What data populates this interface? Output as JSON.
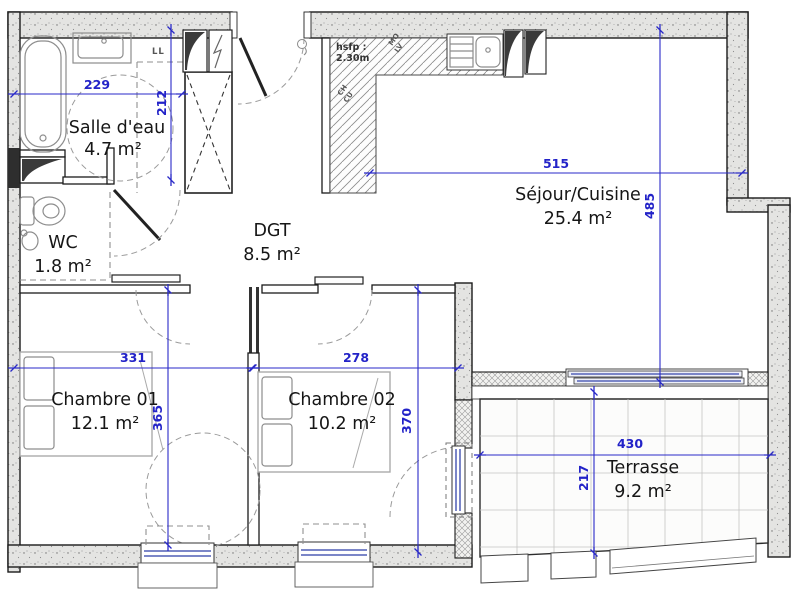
{
  "plan": {
    "rooms": [
      {
        "name": "Salle d'eau",
        "area": "4.7 m²"
      },
      {
        "name": "WC",
        "area": "1.8 m²"
      },
      {
        "name": "DGT",
        "area": "8.5 m²"
      },
      {
        "name": "Séjour/Cuisine",
        "area": "25.4 m²"
      },
      {
        "name": "Chambre 01",
        "area": "12.1 m²"
      },
      {
        "name": "Chambre 02",
        "area": "10.2 m²"
      },
      {
        "name": "Terrasse",
        "area": "9.2 m²"
      }
    ],
    "dims": {
      "salle_deau_width": "229",
      "salle_deau_height": "212",
      "sejour_width": "515",
      "sejour_height": "485",
      "chambre01_width": "331",
      "chambre01_height": "365",
      "chambre02_width": "278",
      "chambre02_height": "370",
      "terrasse_width": "430",
      "terrasse_height": "217"
    },
    "annotations": {
      "washing_machine": "LL",
      "ceiling_height_label": "hsfp :",
      "ceiling_height_value": "2.30m",
      "microwave": "MO",
      "dishwasher": "LV",
      "boiler_1": "CH",
      "boiler_2": "CU"
    },
    "colors": {
      "dimension": "#2323c8",
      "window": "#7b86c8",
      "wall_fill": "#e4e4e2"
    }
  }
}
